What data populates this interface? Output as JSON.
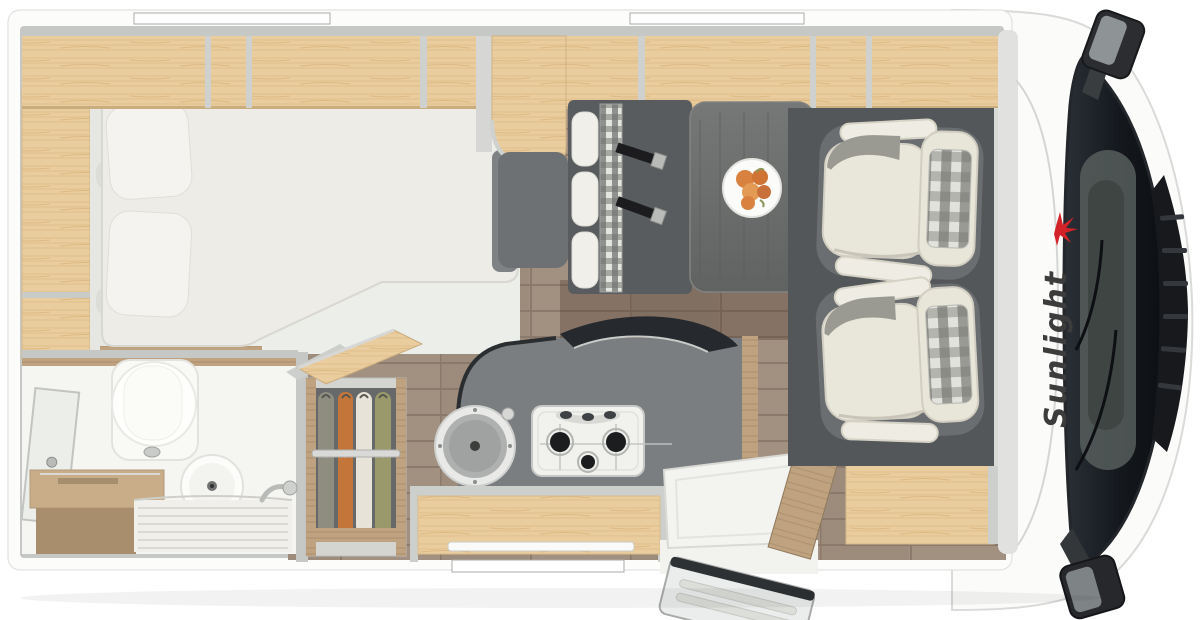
{
  "diagram": {
    "type": "motorhome-floorplan-top-view",
    "brand": {
      "label": "Sunlight",
      "accent_color": "#d42328",
      "text_color": "#3c3c3c"
    },
    "colors": {
      "body_white": "#fbfbfa",
      "wall_grey": "#c6c8c5",
      "wood_light": "#eacd9e",
      "wood_mid": "#bfa27f",
      "floor_brown": "#a29080",
      "kitchen_counter_grey": "#7b7e80",
      "seat_platform_grey": "#53575a",
      "seat_ivory": "#e9e6da",
      "table_grey": "#6f7170",
      "windshield_dark": "#1a1e23",
      "mattress_white": "#edece6",
      "wardrobe_clothes": [
        "#8e8d80",
        "#c4763a",
        "#e7e3d8",
        "#99996b"
      ]
    },
    "areas": [
      {
        "name": "rear-bed"
      },
      {
        "name": "bathroom"
      },
      {
        "name": "wardrobe"
      },
      {
        "name": "kitchen"
      },
      {
        "name": "dinette"
      },
      {
        "name": "entry-door"
      },
      {
        "name": "swivel-cab-seats"
      },
      {
        "name": "driver-cab"
      }
    ]
  }
}
